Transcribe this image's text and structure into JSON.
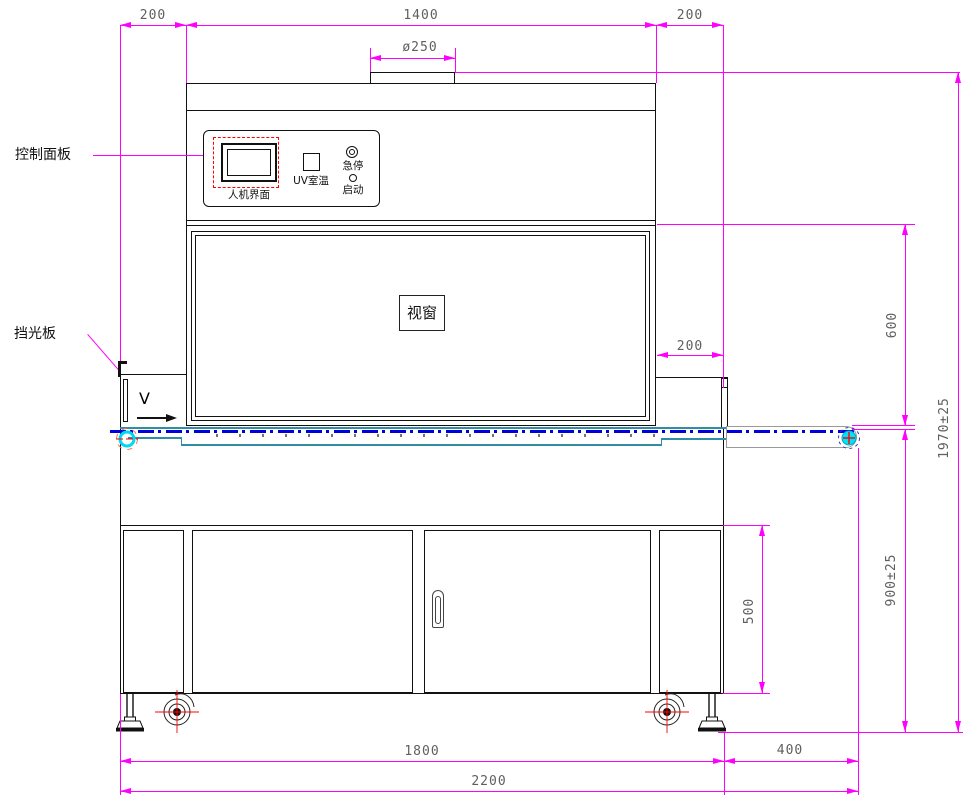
{
  "drawing": {
    "labels": {
      "control_panel": "控制面板",
      "light_shield": "挡光板",
      "hmi": "人机界面",
      "uv_temp": "UV室温",
      "emergency_stop": "急停",
      "start": "启动",
      "viewport": "视窗",
      "direction": "V"
    },
    "dimensions": {
      "top_left": "200",
      "top_center": "1400",
      "top_right": "200",
      "duct_diameter": "ø250",
      "right_offset": "200",
      "window_to_belt": "600",
      "total_height": "1970±25",
      "belt_height": "900±25",
      "cabinet_door": "500",
      "base_width": "1800",
      "belt_extension": "400",
      "total_width": "2200"
    },
    "colors": {
      "dimension": "#FF00FF",
      "dim_text": "#5F5F5F",
      "outline": "#111111",
      "belt_centerline": "#0000DD",
      "belt_frame": "#2F8EA3",
      "pulley": "#00E0F5",
      "accent_red": "#FF0000",
      "extension_gray": "#9A9A9A"
    }
  }
}
